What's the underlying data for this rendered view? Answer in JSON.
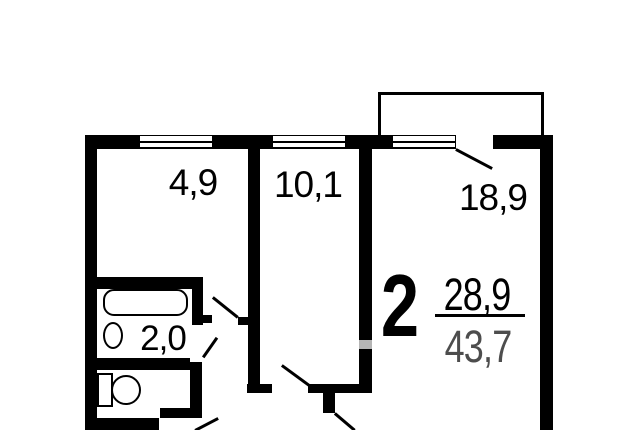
{
  "floor_plan": {
    "type": "apartment-floor-plan",
    "rooms": [
      {
        "id": "kitchen",
        "area": "4,9"
      },
      {
        "id": "bedroom",
        "area": "10,1"
      },
      {
        "id": "living-room",
        "area": "18,9"
      },
      {
        "id": "bathroom",
        "area": "2,0"
      }
    ],
    "summary": {
      "room_count": "2",
      "living_area": "28,9",
      "total_area": "43,7"
    },
    "colors": {
      "wall": "#000000",
      "background": "#ffffff",
      "faded_wall_gap": "#b5b5b5",
      "total_area_text": "#4d4d4d"
    }
  }
}
